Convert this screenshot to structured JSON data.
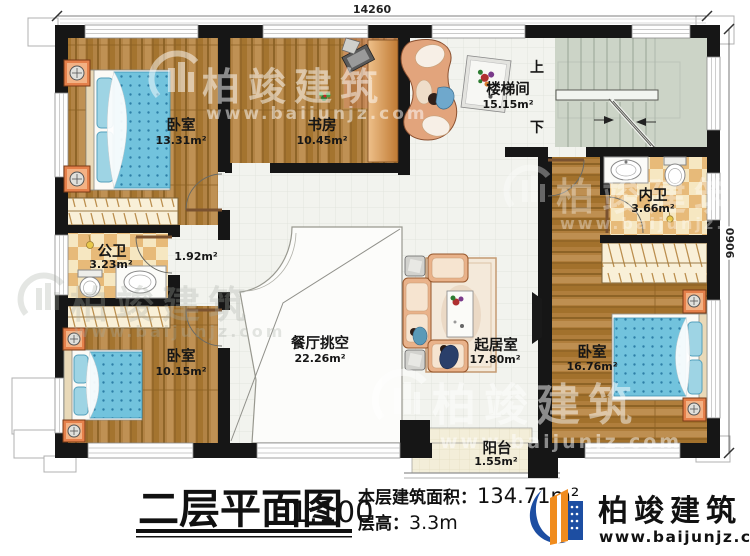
{
  "plan": {
    "dimension_width": "14260",
    "dimension_height": "9060",
    "stairs": {
      "up": "上",
      "down": "下"
    },
    "rooms": {
      "bedroom_top_left": {
        "name": "卧室",
        "area": "13.31m²"
      },
      "study": {
        "name": "书房",
        "area": "10.45m²"
      },
      "stairwell": {
        "name": "楼梯间",
        "area": "15.15m²"
      },
      "ensuite_bathroom": {
        "name": "内卫",
        "area": "3.66m²"
      },
      "public_bathroom": {
        "name": "公卫",
        "area": "3.23m²"
      },
      "corridor": {
        "area": "1.92m²"
      },
      "bedroom_bottom_left": {
        "name": "卧室",
        "area": "10.15m²"
      },
      "dining_void": {
        "name": "餐厅挑空",
        "area": "22.26m²"
      },
      "living_room": {
        "name": "起居室",
        "area": "17.80m²"
      },
      "bedroom_right": {
        "name": "卧室",
        "area": "16.76m²"
      },
      "balcony": {
        "name": "阳台",
        "area": "1.55m²"
      }
    }
  },
  "title_block": {
    "title": "二层平面图",
    "scale": "1:100",
    "area_label": "本层建筑面积：",
    "area_value": "134.71m²",
    "floor_height_label": "层高：",
    "floor_height_value": "3.3m"
  },
  "brand": {
    "name": "柏竣建筑",
    "website": "www.baijunjz.com"
  },
  "watermark": {
    "text": "柏竣建筑",
    "website": "www.baijunjz.com"
  },
  "colors": {
    "wall": "#161616",
    "wood_floor": "#b28345",
    "hall_tile": "#f2f3ee",
    "stair_floor": "#ccd4c7",
    "bath_tile": "#e7ba79",
    "bedding_blue": "#72c3dd",
    "brand_blue": "#1d4ea2",
    "brand_orange": "#f08c1e"
  }
}
